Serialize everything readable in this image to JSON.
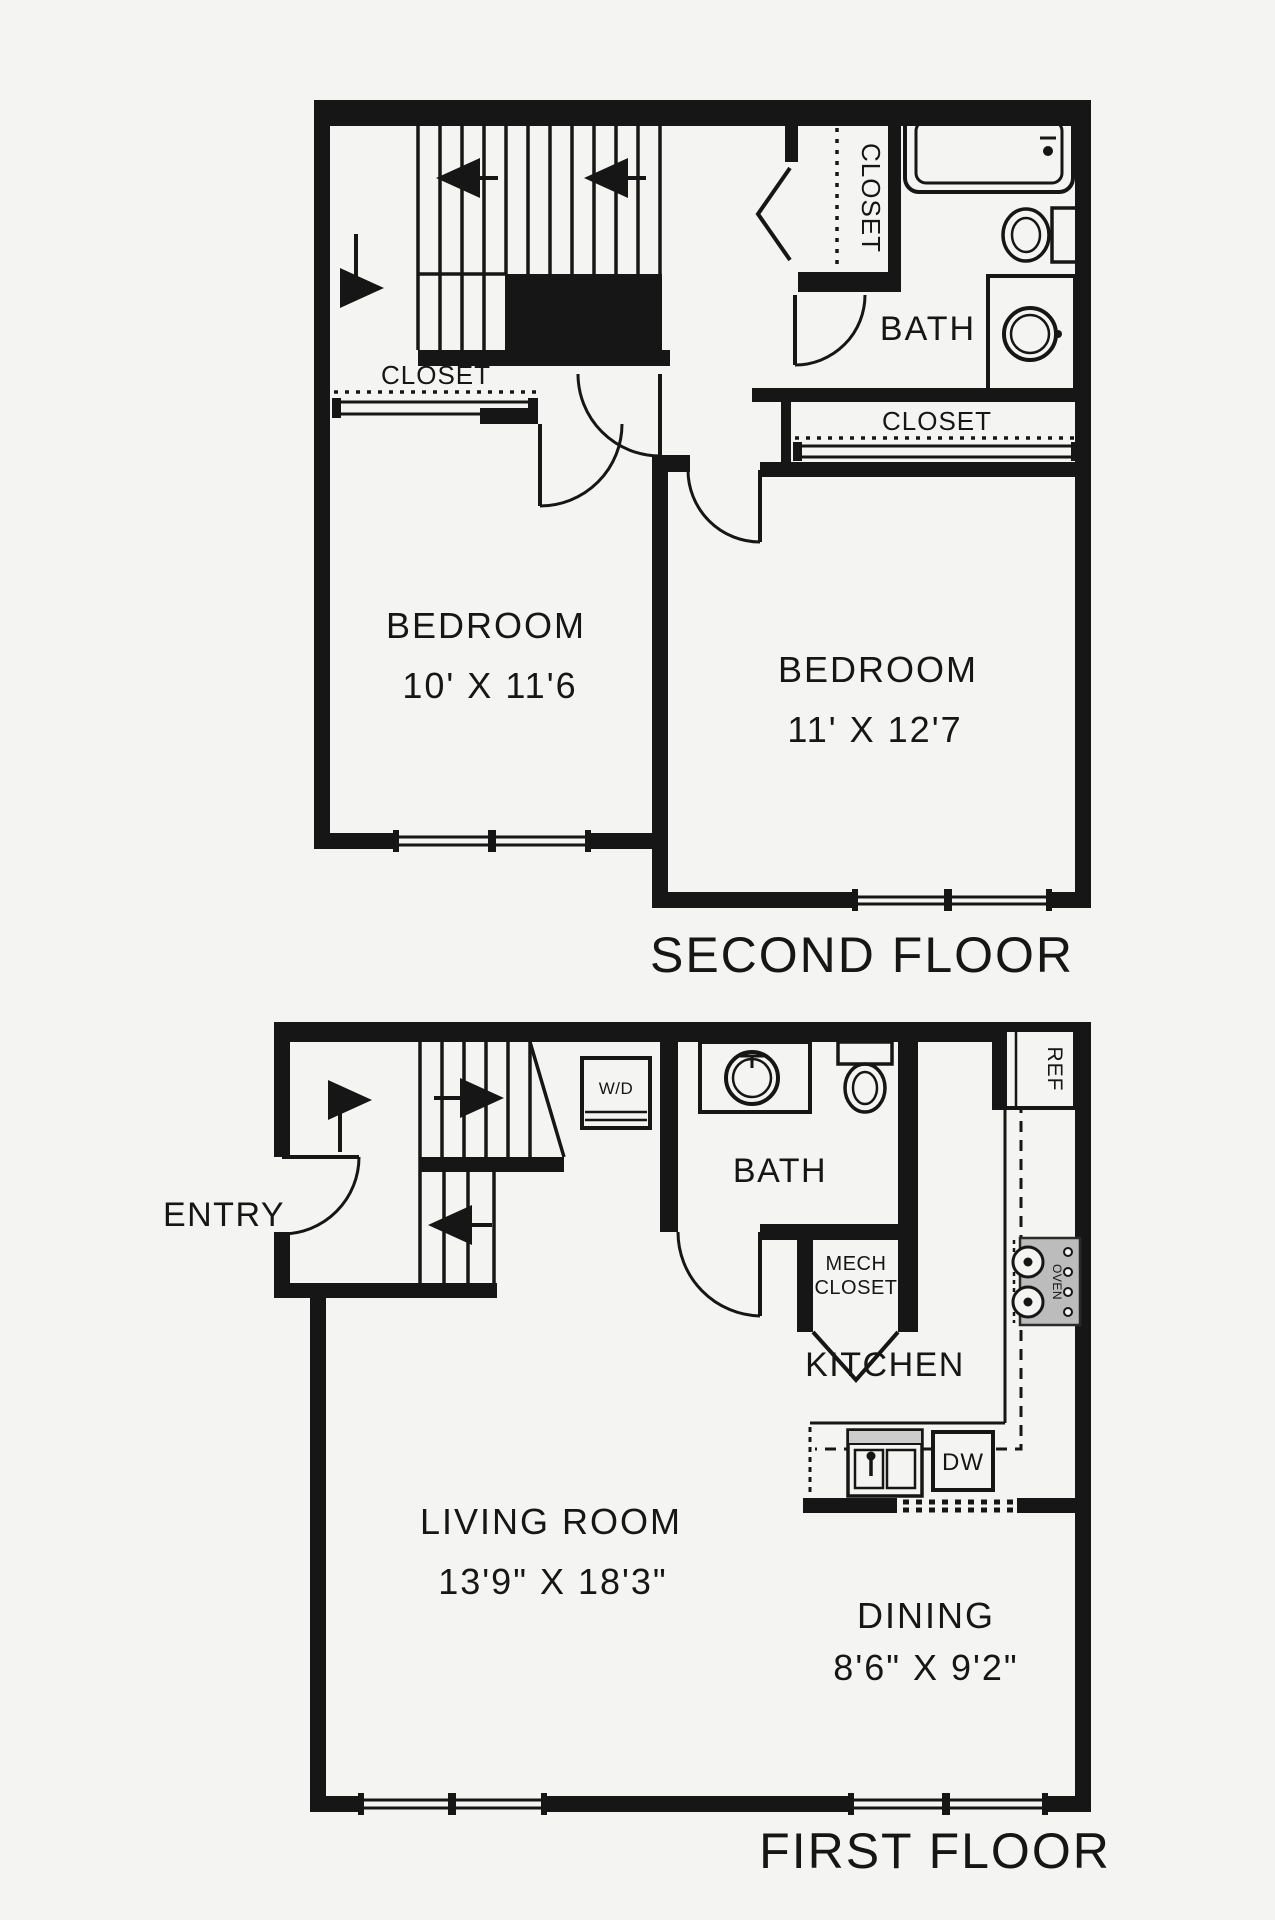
{
  "second_floor": {
    "title": "SECOND FLOOR",
    "bedroom1": {
      "name": "BEDROOM",
      "dims": "10' X 11'6"
    },
    "bedroom2": {
      "name": "BEDROOM",
      "dims": "11' X 12'7"
    },
    "bath": "BATH",
    "closet_bedroom1": "CLOSET",
    "closet_hall": "CLOSET",
    "closet_bedroom2": "CLOSET"
  },
  "first_floor": {
    "title": "FIRST FLOOR",
    "entry": "ENTRY",
    "bath": "BATH",
    "mech_closet_line1": "MECH",
    "mech_closet_line2": "CLOSET",
    "kitchen": "KITCHEN",
    "living_room": {
      "name": "LIVING ROOM",
      "dims": "13'9\" X 18'3\""
    },
    "dining": {
      "name": "DINING",
      "dims": "8'6\" X 9'2\""
    },
    "appliances": {
      "washer_dryer": "W/D",
      "refrigerator": "REF",
      "dishwasher": "DW",
      "oven": "OVEN"
    }
  },
  "colors": {
    "ink": "#161616",
    "background": "#f4f4f2",
    "appliance_gray": "#bcbcbc",
    "counter_gray": "#cccccc"
  }
}
